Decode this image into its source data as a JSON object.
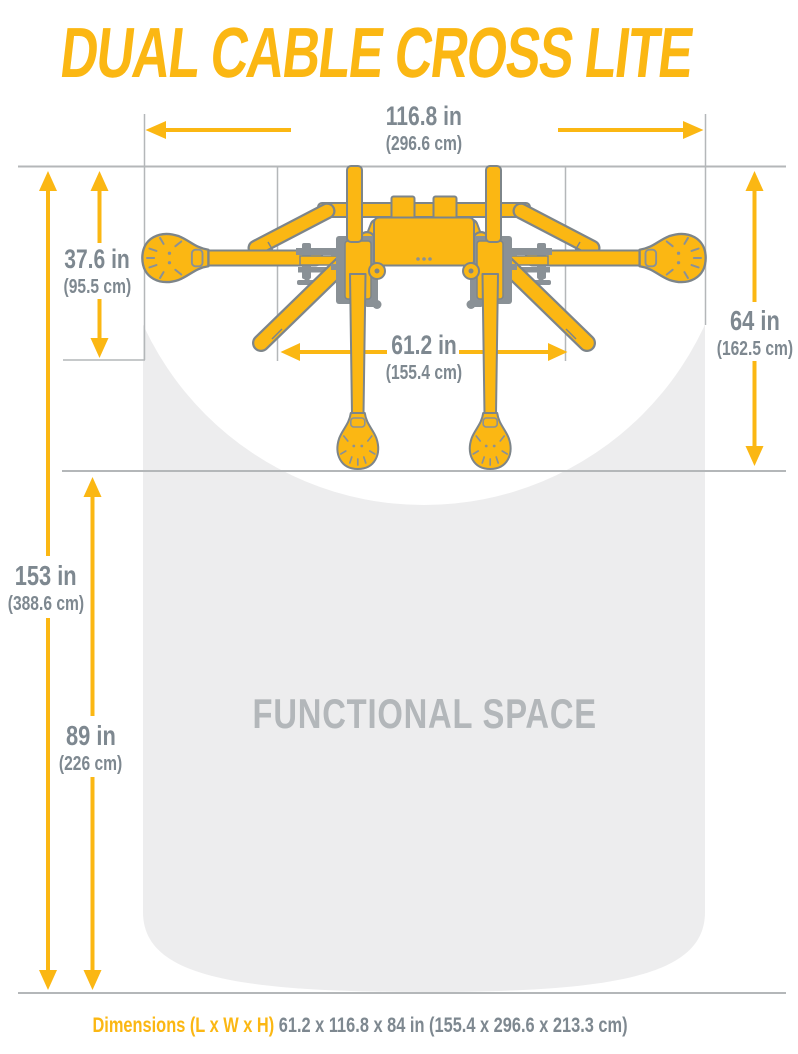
{
  "header": {
    "title": "DUAL CABLE CROSS LITE",
    "model": "#G424"
  },
  "dims": {
    "total_width": {
      "inches": "116.8 in",
      "metric": "(296.6 cm)"
    },
    "base_depth": {
      "inches": "37.6 in",
      "metric": "(95.5 cm)"
    },
    "machine_depth": {
      "inches": "64 in",
      "metric": "(162.5 cm)"
    },
    "inner_width": {
      "inches": "61.2 in",
      "metric": "(155.4 cm)"
    },
    "total_length": {
      "inches": "153 in",
      "metric": "(388.6 cm)"
    },
    "functional_depth": {
      "inches": "89 in",
      "metric": "(226 cm)"
    }
  },
  "functional_space": {
    "label": "FUNCTIONAL SPACE"
  },
  "footer": {
    "label": "Dimensions (L x W x H)",
    "value": "61.2 x 116.8 x 84 in (155.4 x 296.6 x 213.3 cm)"
  },
  "colors": {
    "accent_yellow": "#FBB713",
    "dim_text_gray": "#7E8890",
    "model_gray": "#9CA2A7",
    "space_fill": "#EDEDEE",
    "space_text": "#B3B7BA",
    "guide_line": "#B4B7B9",
    "machine_outline": "#7D858A"
  }
}
